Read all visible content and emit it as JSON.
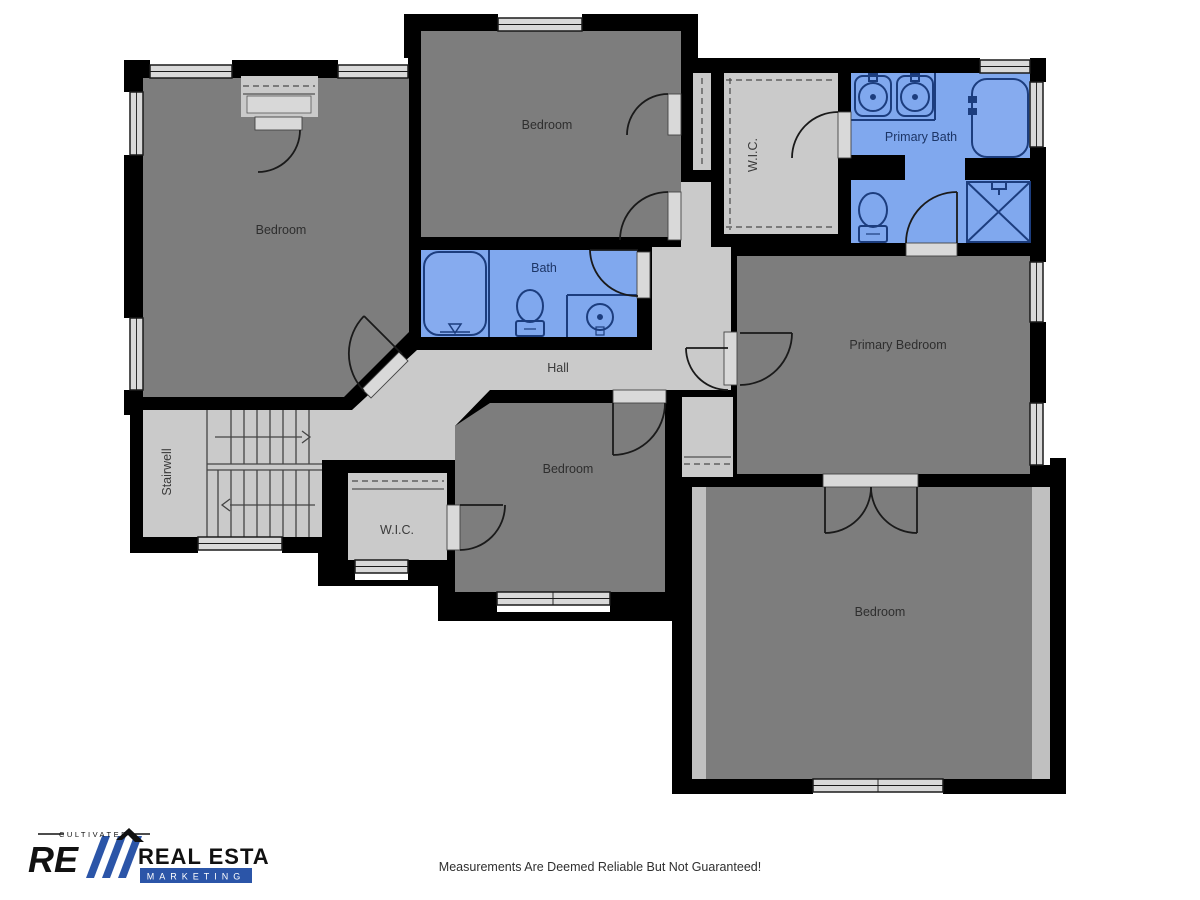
{
  "labels": {
    "bedroom_tl": "Bedroom",
    "bedroom_tm": "Bedroom",
    "bedroom_mid": "Bedroom",
    "bedroom_bottom": "Bedroom",
    "primary_bedroom": "Primary Bedroom",
    "primary_bath": "Primary Bath",
    "bath": "Bath",
    "hall": "Hall",
    "wic_upper": "W.I.C.",
    "wic_lower": "W.I.C.",
    "stairwell": "Stairwell"
  },
  "footer": {
    "disclaimer": "Measurements Are Deemed Reliable But Not Guaranteed!"
  },
  "logo": {
    "tagline": "CULTIVATED",
    "line1": "REAL ESTATE",
    "line2": "MARKETING"
  },
  "colors": {
    "wall_black": "#000000",
    "room_gray": "#7d7d7d",
    "circulation_gray": "#cacaca",
    "slope_gray": "#c0c0c0",
    "window_gray": "#d9d9d9",
    "bath_blue": "#80a8ee",
    "fixture_navy": "#1c3d7e",
    "logo_blue": "#2b55a8"
  }
}
